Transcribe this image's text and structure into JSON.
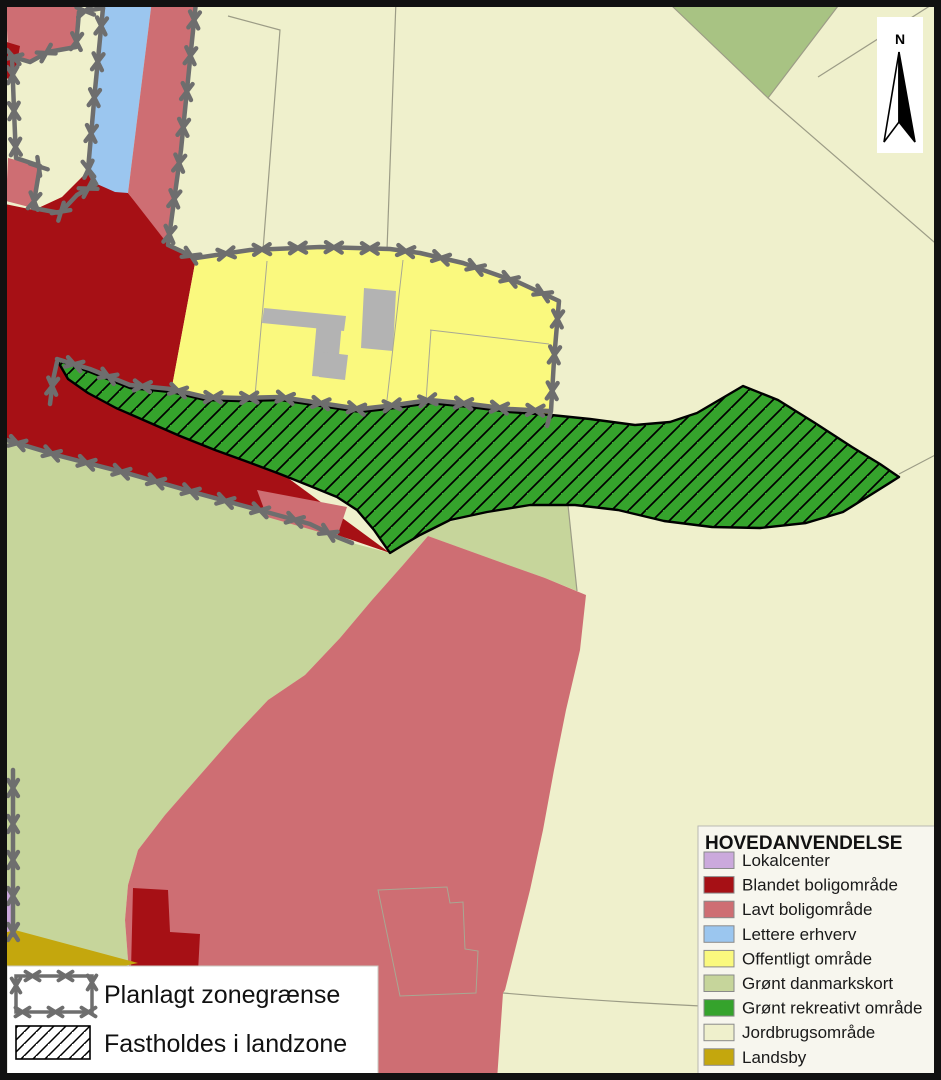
{
  "colors": {
    "olive_dark": "#A8C383",
    "building_gray": "#B3B3B3",
    "boundary_gray": "#6E6E6E",
    "parcel_line": "#9C9C86",
    "frame_black": "#111111",
    "hatch_line": "#000000",
    "legend_bg": "#F7F6EE",
    "white": "#FFFFFF"
  },
  "north_arrow": {
    "label": "N"
  },
  "legend_overlay": {
    "items": [
      {
        "label": "Planlagt zonegrænse",
        "symbol": "zone-boundary-rect"
      },
      {
        "label": "Fastholdes i landzone",
        "symbol": "diagonal-hatch-rect"
      }
    ]
  },
  "legend_main": {
    "title": "HOVEDANVENDELSE",
    "items": [
      {
        "label": "Lokalcenter",
        "color": "#CBA9DC"
      },
      {
        "label": "Blandet boligområde",
        "color": "#A61015"
      },
      {
        "label": "Lavt boligområde",
        "color": "#CE6E73"
      },
      {
        "label": "Lettere erhverv",
        "color": "#9BC6EF"
      },
      {
        "label": "Offentligt område",
        "color": "#FAF97E"
      },
      {
        "label": "Grønt danmarkskort",
        "color": "#C6D59B"
      },
      {
        "label": "Grønt rekreativt område",
        "color": "#35A32C"
      },
      {
        "label": "Jordbrugsområde",
        "color": "#EFF0CC"
      },
      {
        "label": "Landsby",
        "color": "#C4A70D"
      }
    ]
  }
}
